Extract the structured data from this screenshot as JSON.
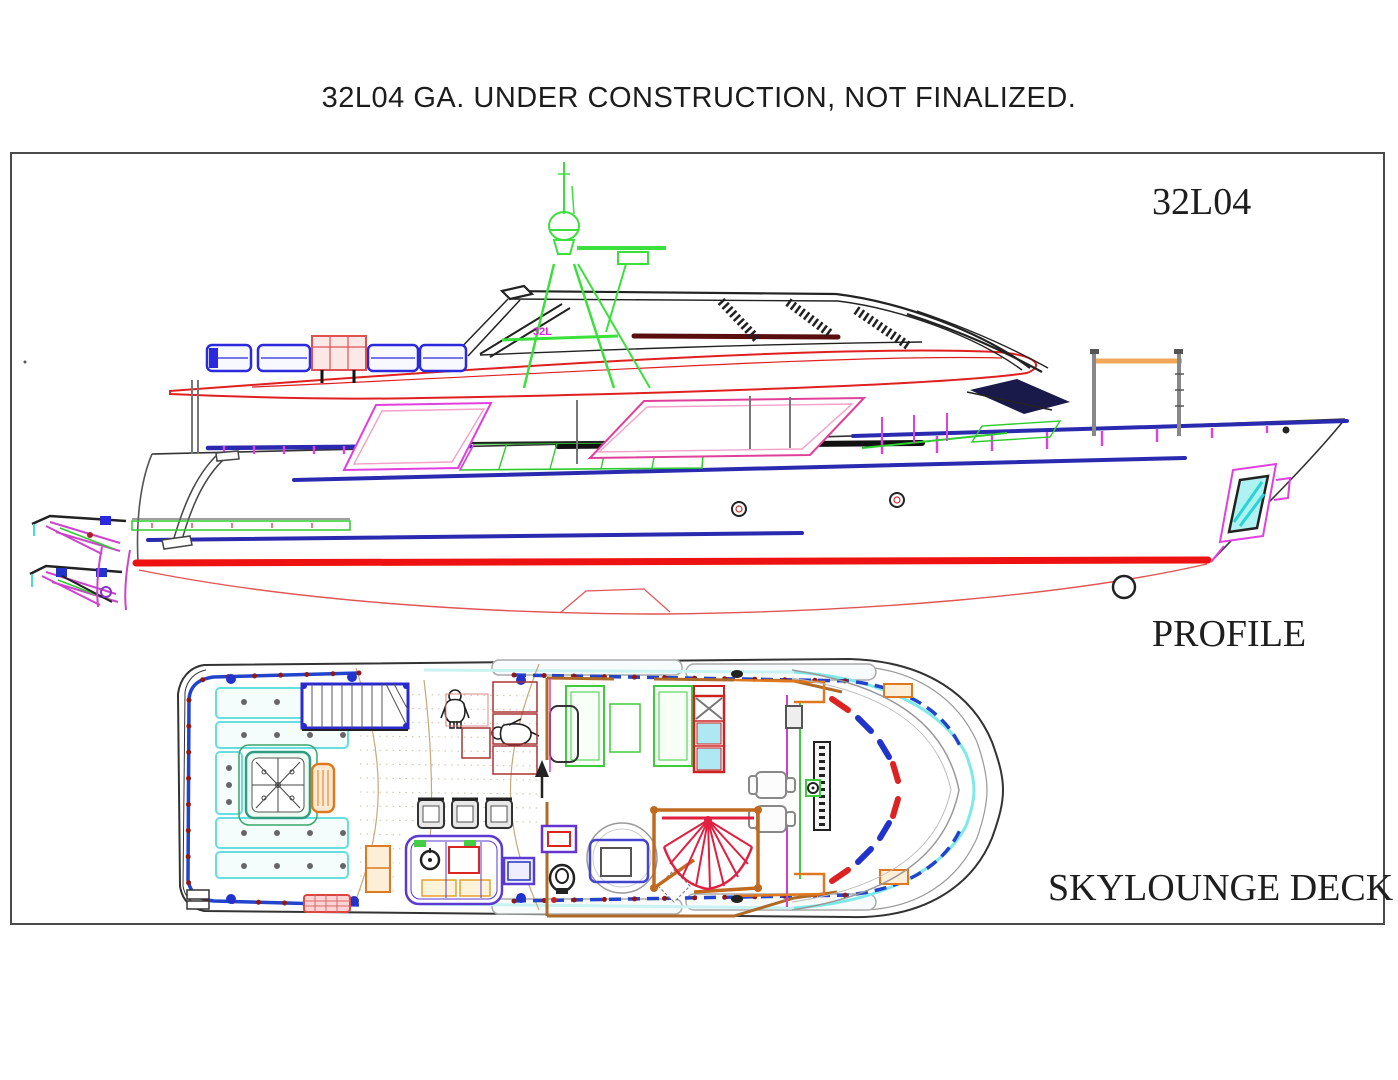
{
  "page": {
    "title": "32L04 GA. UNDER CONSTRUCTION, NOT FINALIZED."
  },
  "drawing": {
    "model_label": "32L04",
    "hull_logo_text": "32L",
    "views": [
      {
        "id": "profile",
        "label": "PROFILE"
      },
      {
        "id": "skylounge-deck",
        "label": "SKYLOUNGE DECK"
      }
    ],
    "palette": {
      "boot_stripe_red": "#ee1111",
      "hull_red": "#e05555",
      "cad_blue": "#2a2ab0",
      "railing_blue": "#2244cc",
      "magenta": "#e040e0",
      "pink": "#f4a0c8",
      "green": "#33cc33",
      "mast_green": "#3ce03c",
      "cyan": "#55dede",
      "orange": "#e0801f",
      "wall_brown": "#b06a28",
      "maroon": "#8b1a1a",
      "ink": "#222222"
    }
  }
}
